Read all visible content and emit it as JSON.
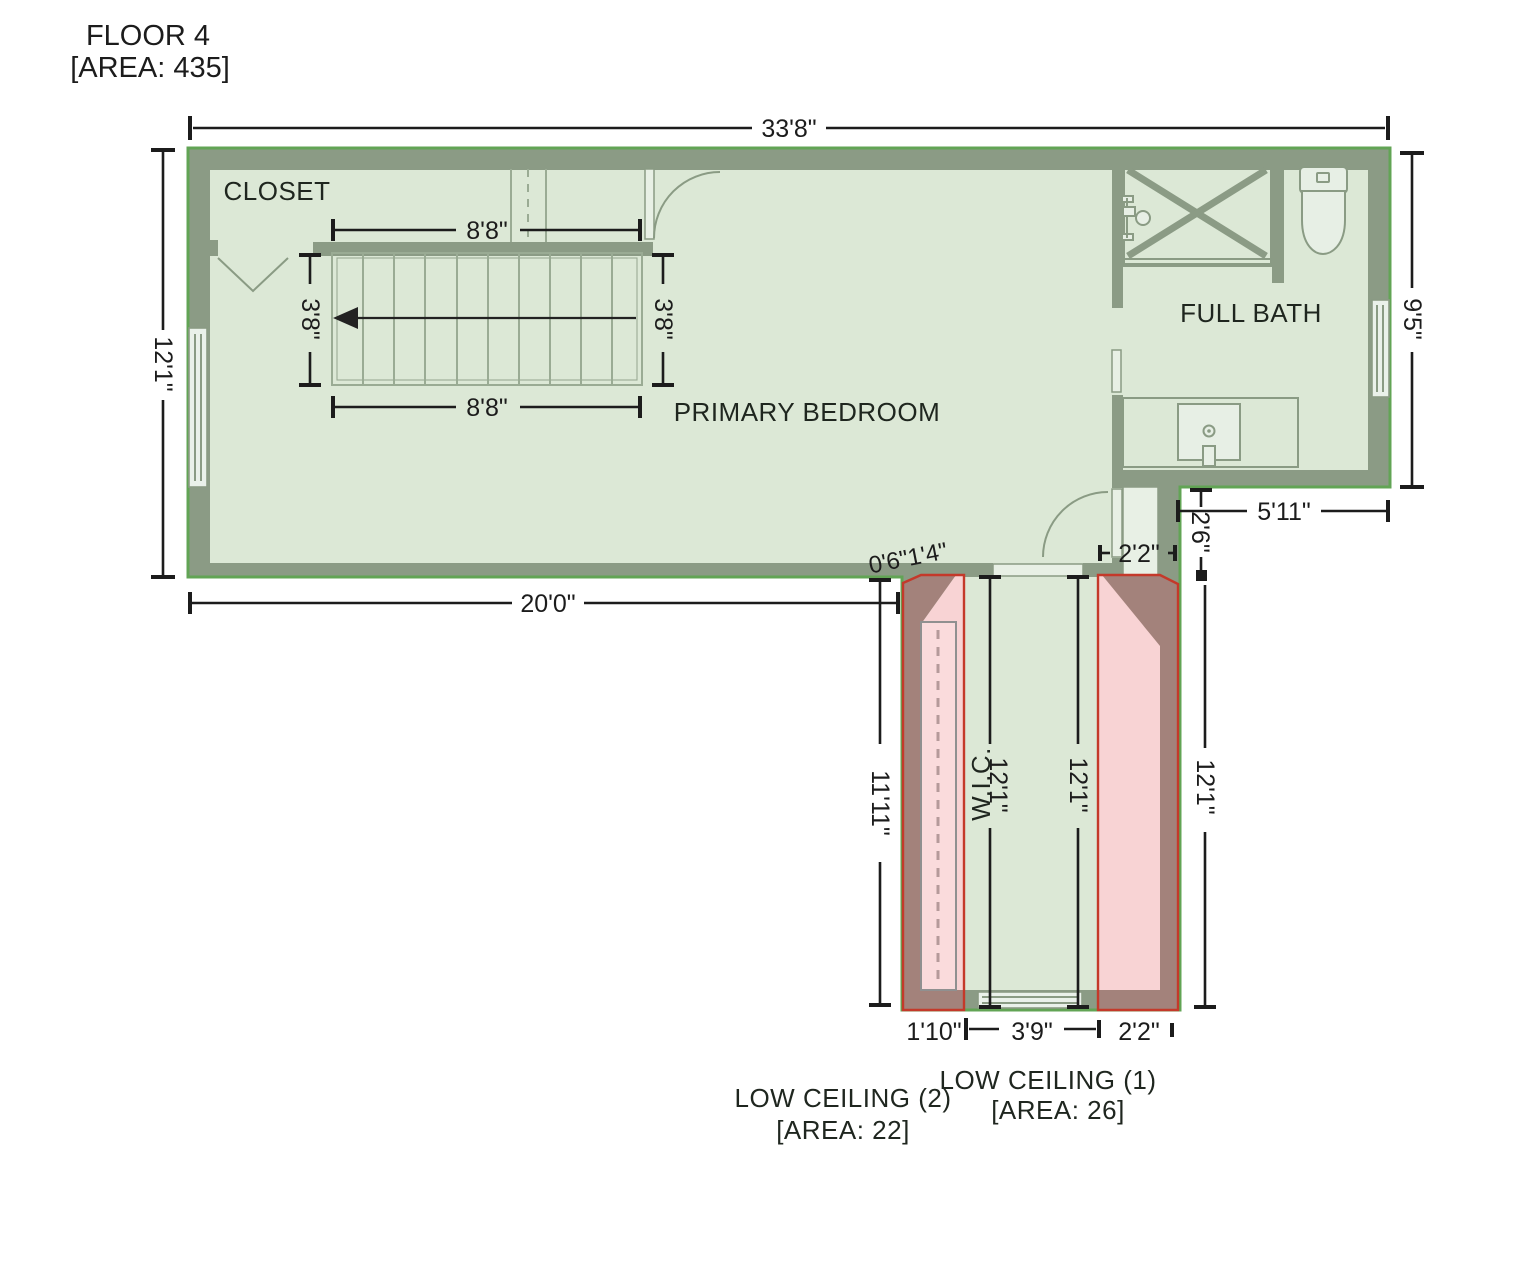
{
  "title": {
    "line1": "FLOOR 4",
    "line2": "[AREA: 435]"
  },
  "rooms": {
    "closet": "CLOSET",
    "primary_bedroom": "PRIMARY BEDROOM",
    "full_bath": "FULL BATH",
    "wic": "W.I.C."
  },
  "low_ceiling": {
    "area1_label": "LOW CEILING (1)",
    "area1_area": "[AREA: 26]",
    "area2_label": "LOW CEILING (2)",
    "area2_area": "[AREA: 22]"
  },
  "dims": {
    "overall_width": "33'8\"",
    "left_height": "12'1\"",
    "bath_height": "9'5\"",
    "stair_width_top": "8'8\"",
    "stair_width_bottom": "8'8\"",
    "stair_depth_left": "3'8\"",
    "stair_depth_right": "3'8\"",
    "bedroom_width": "20'0\"",
    "wall_jog": "0'6\"1'4\"",
    "bath_entry_width": "2'2\"",
    "step_width": "5'11\"",
    "step_height": "2'6\"",
    "strip2_height": "11'11\"",
    "wic_height": "12'1\"",
    "corridor_height": "12'1\"",
    "strip1_height": "12'1\"",
    "strip2_width": "1'10\"",
    "wic_width": "3'9\"",
    "strip1_width": "2'2\""
  },
  "colors": {
    "wall": "#8b9b85",
    "floor": "#dce8d6",
    "floor_light": "#e8f0e5",
    "fixture": "#8a9b84",
    "pink": "#f8d3d4",
    "brown": "#a3827b",
    "red": "#c4392a",
    "edge": "#62a455",
    "dim": "#1c1c1c",
    "text": "#1c1c1c"
  }
}
